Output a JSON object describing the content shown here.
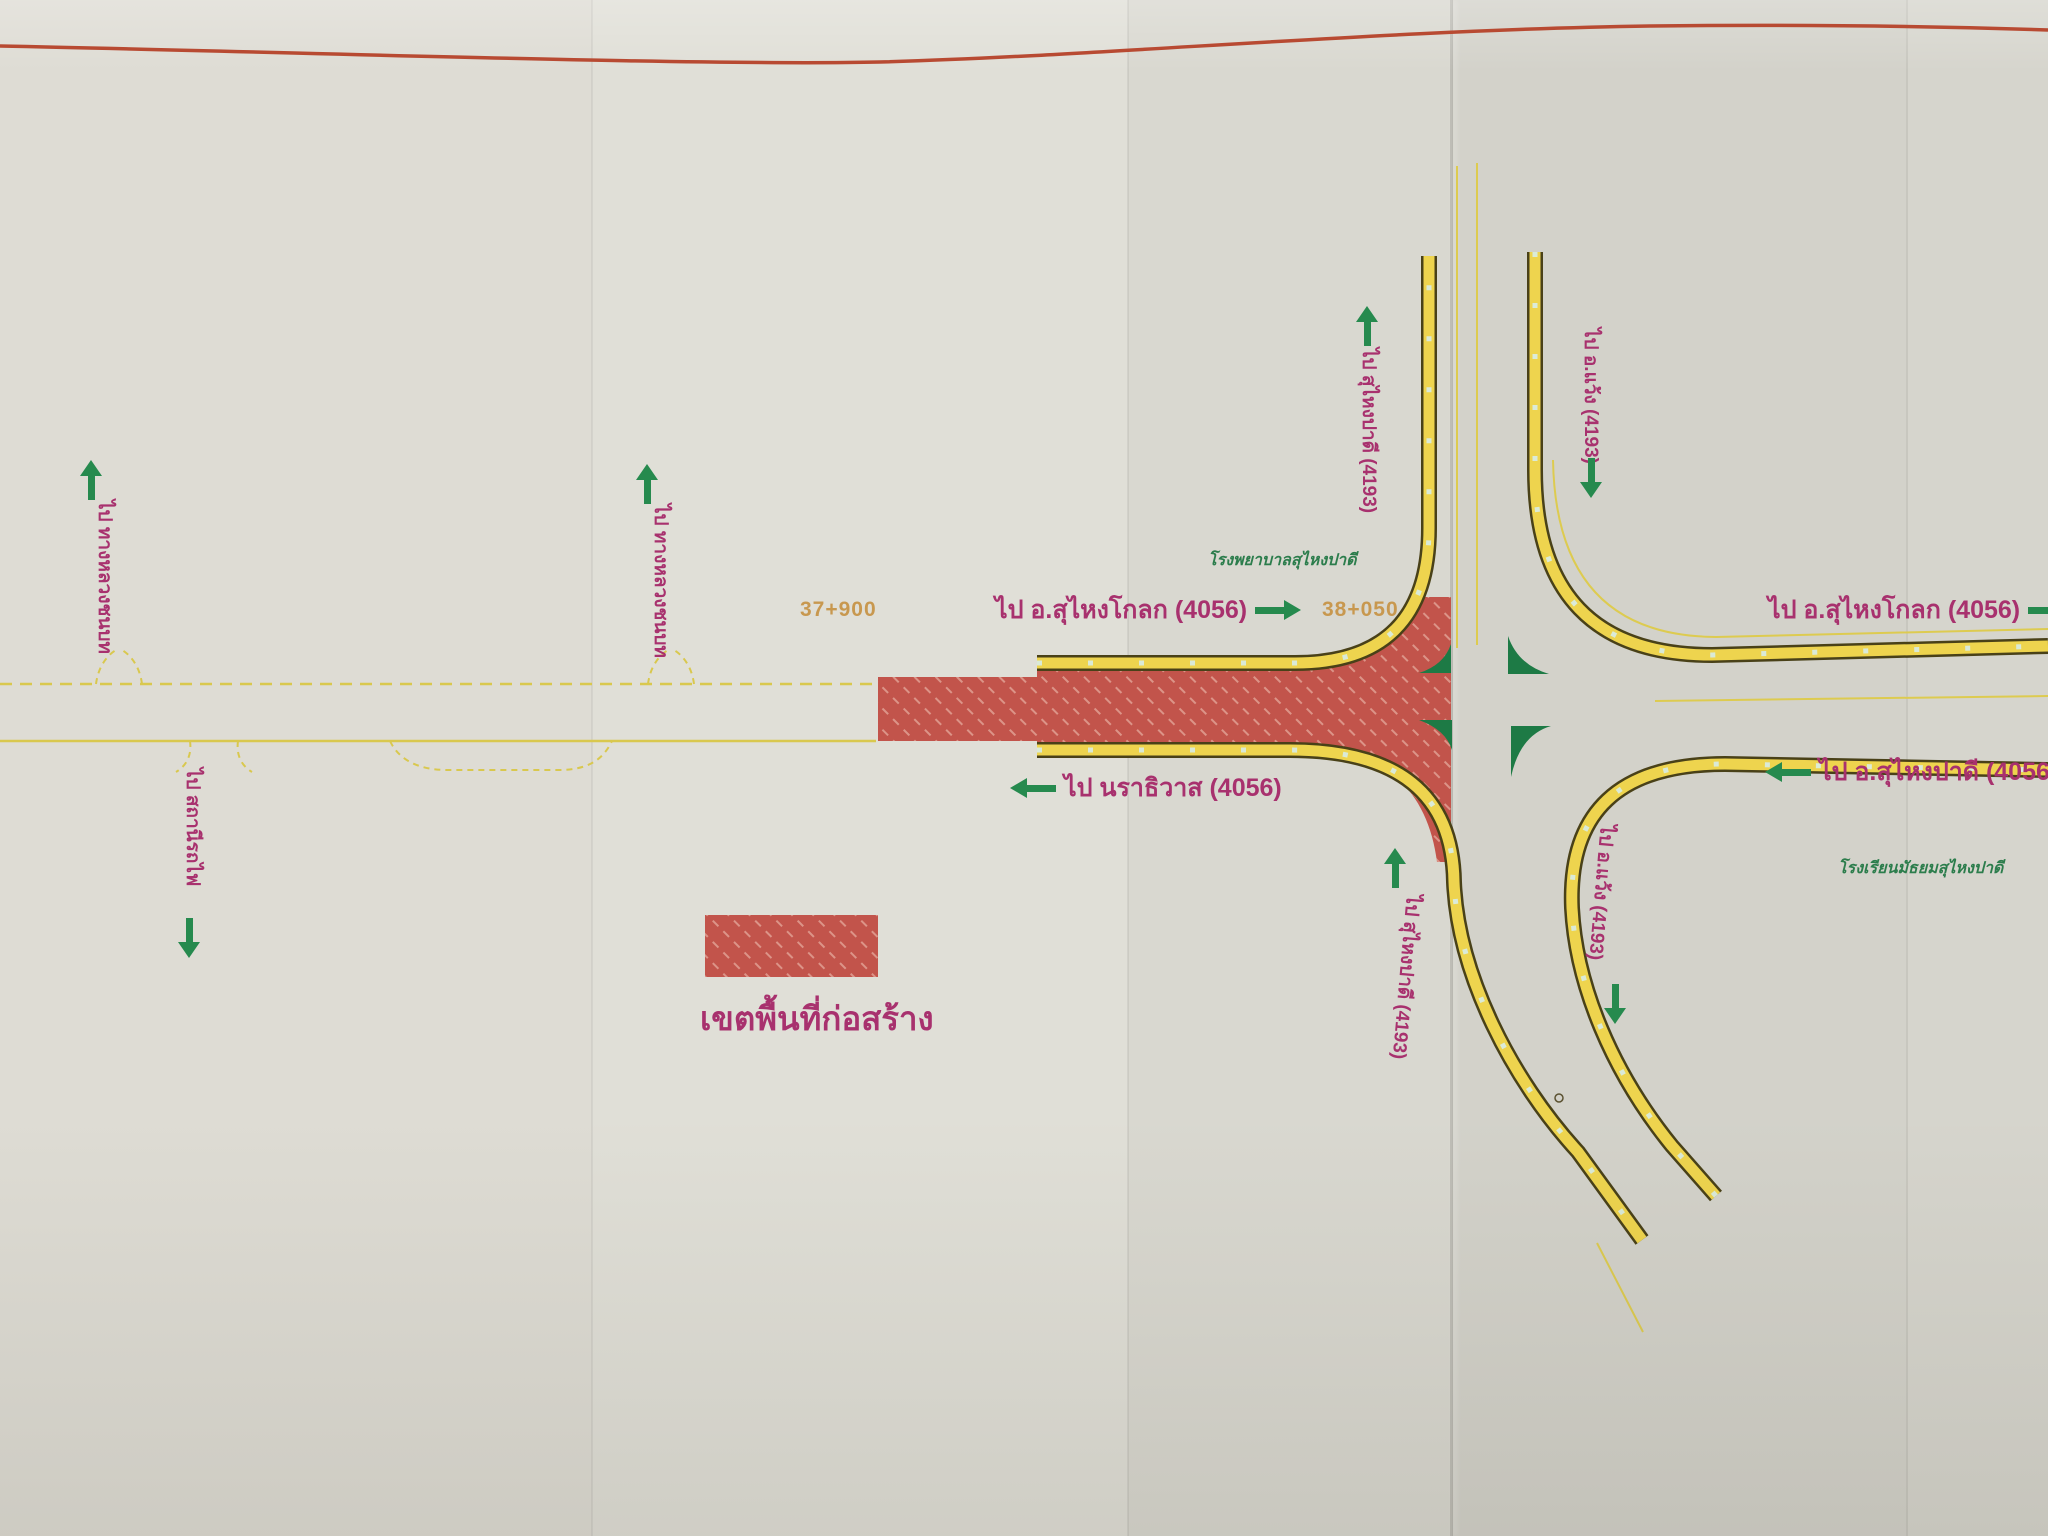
{
  "document": {
    "type": "road-construction-layout-plan",
    "legend": {
      "label": "เขตพื้นที่ก่อสร้าง"
    },
    "stations": {
      "west": "37+900",
      "junction": "38+050"
    },
    "labels": {
      "kolok_west": "ไป อ.สุไหงโกลก (4056)",
      "kolok_east": "ไป อ.สุไหงโกลก (4056)",
      "padi_east": "ไป อ.สุไหงปาดี (4056)",
      "narathiwat": "ไป นราธิวาส (4056)",
      "padi_north_upper": "ไป สุไหงปาดี (4193)",
      "waeng_upper": "ไป อ.แว้ง (4193)",
      "padi_north_lower": "ไป สุไหงปาดี (4193)",
      "waeng_lower": "ไป อ.แว้ง (4193)",
      "side_road_far_west": "ไป ทางหลวงชนบท",
      "side_road_mid_west": "ไป ทางหลวงชนบท",
      "side_road_south": "ไป สถานีรถไฟ",
      "hospital": "โรงพยาบาลสุไหงปาดี",
      "school": "โรงเรียนมัธยมสุไหงปาดี"
    },
    "routes": [
      "4056",
      "4193"
    ],
    "colors": {
      "construction_red": "#c2544b",
      "road_yellow": "#eed44e",
      "road_edge_dark": "#494118",
      "arrow_green": "#268a4e",
      "island_green": "#1d7a45",
      "label_magenta": "#a8316e",
      "station_orange": "#c8984f",
      "poi_green": "#2c7d4c",
      "paper": "#dbdad2",
      "margin_line_red": "#b84a32"
    }
  }
}
